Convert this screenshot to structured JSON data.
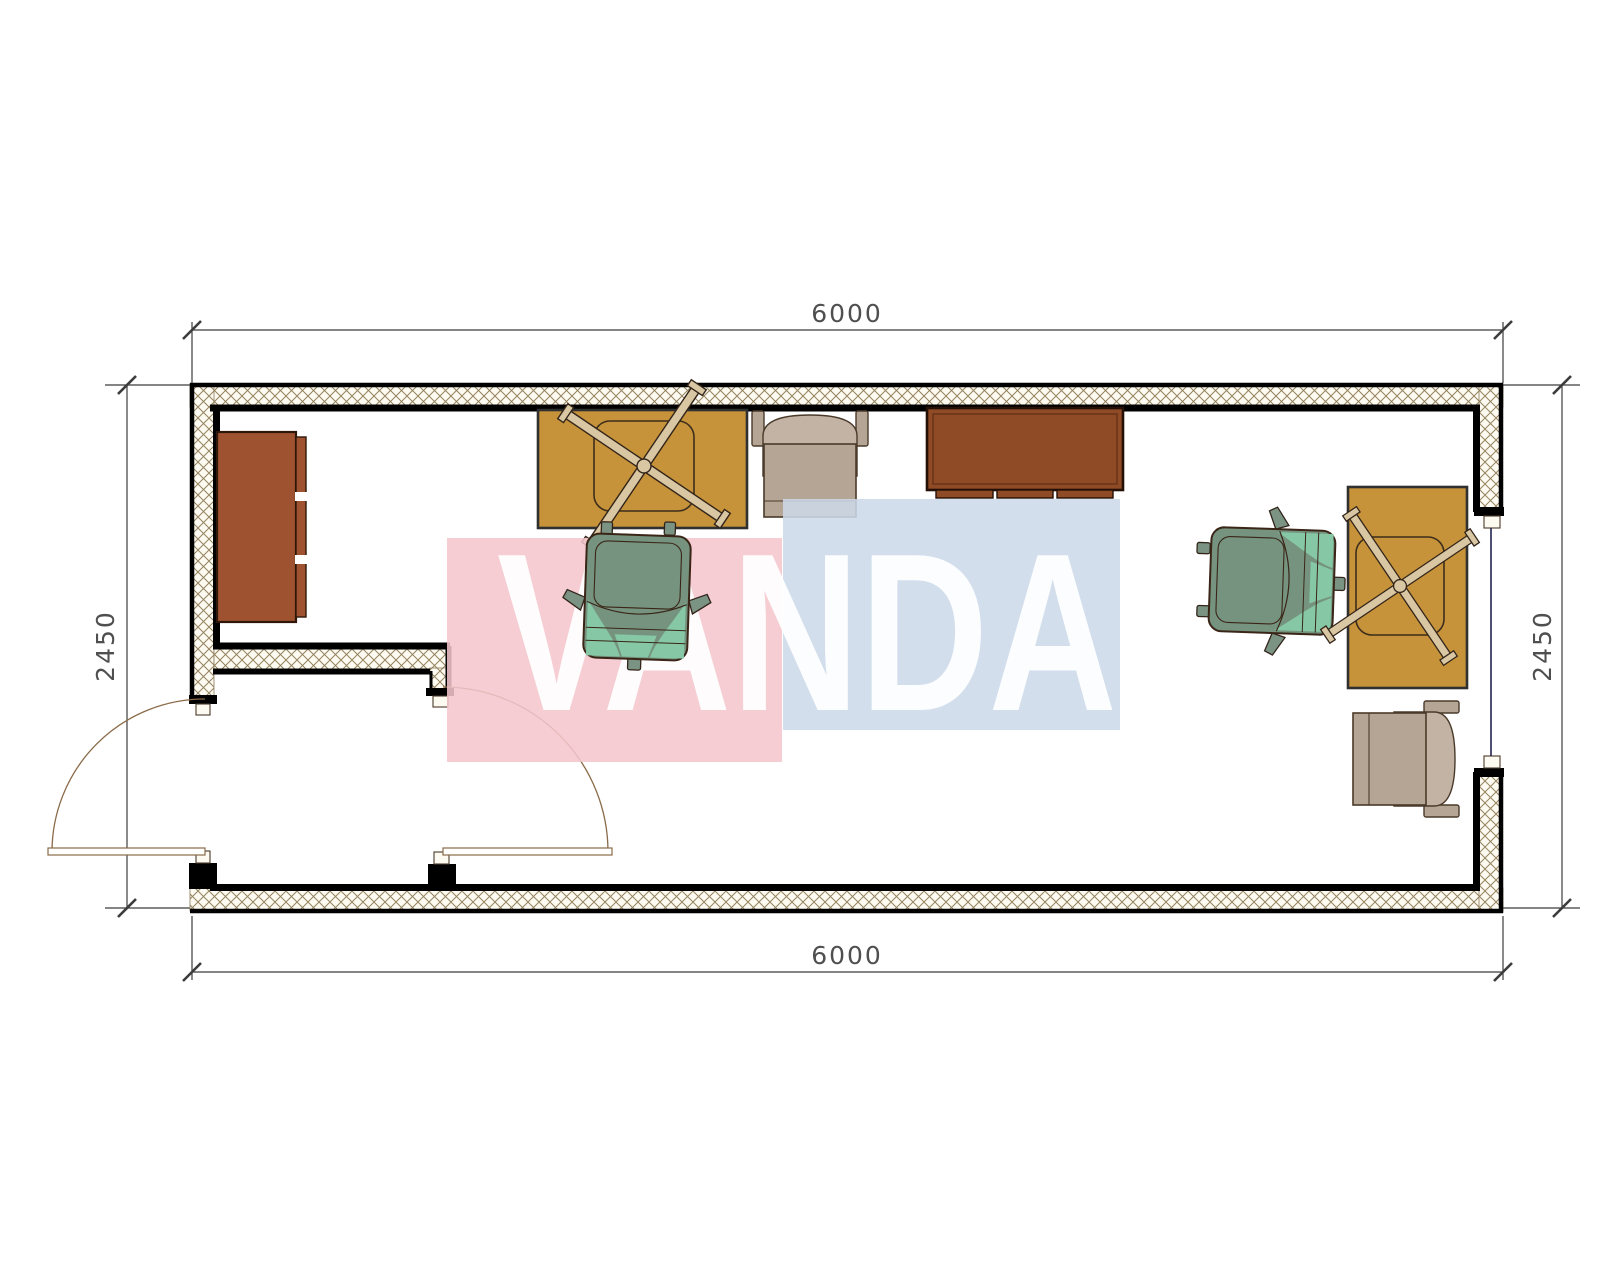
{
  "plan": {
    "type": "floor-plan",
    "description": "container-office-plan-top-view",
    "room_outer_width_mm": "6000",
    "room_outer_depth_mm": "2450"
  },
  "dimensions": {
    "top": "6000",
    "bottom": "6000",
    "left": "2450",
    "right": "2450"
  },
  "watermark": {
    "text": "VANDA",
    "pink_color": "#f3c5cd",
    "blue_color": "#cdd9e9",
    "text_color": "#ffffff"
  },
  "colors": {
    "desk": "#c6933a",
    "wardrobe": "#9e5230",
    "sideboard": "#8f4a26",
    "armchair_body": "#b5a595",
    "armchair_back": "#c3b3a4",
    "chair_body": "#75937f",
    "chair_accent": "#86c7a5",
    "wall_line": "#000000",
    "hatch_line": "#94835f",
    "hatch_bg": "#fdfaf2",
    "dim_line": "#3c3c3c",
    "dim_text": "#4f4f4f",
    "door_arc": "#8a6a48",
    "window_line": "#232350"
  },
  "furniture": [
    {
      "name": "wardrobe-left"
    },
    {
      "name": "desk-top-left"
    },
    {
      "name": "office-chair-left"
    },
    {
      "name": "armchair-top"
    },
    {
      "name": "sideboard-top"
    },
    {
      "name": "office-chair-right"
    },
    {
      "name": "desk-right"
    },
    {
      "name": "armchair-bottom-right"
    }
  ],
  "openings": [
    {
      "name": "entry-door-left",
      "swing": "outward"
    },
    {
      "name": "vestibule-door",
      "swing": "inward"
    },
    {
      "name": "window-right"
    }
  ]
}
